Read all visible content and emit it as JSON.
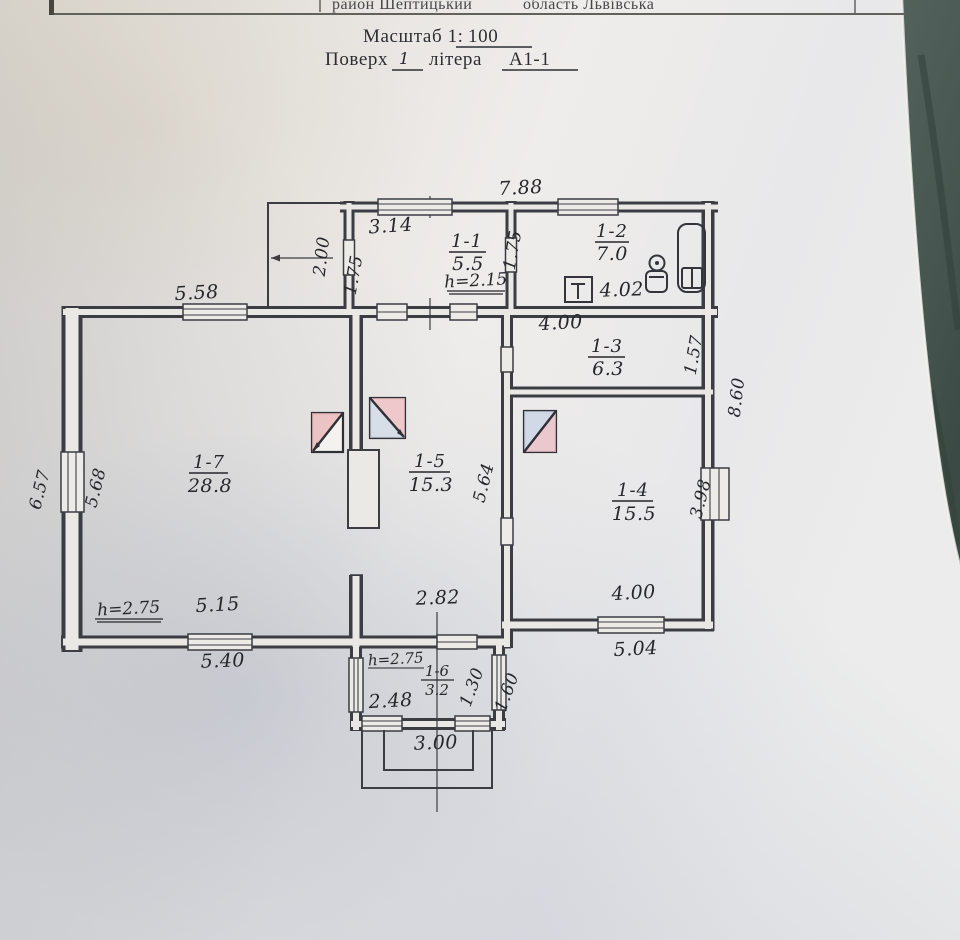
{
  "photo": {
    "paper_color": "#eae8e5",
    "background_color": "#4b5a54"
  },
  "header_table": {
    "district": "район Шептицький",
    "region": "область Львівська"
  },
  "title_block": {
    "scale_label": "Масштаб 1:",
    "scale_value": "100",
    "floor_label": "Поверх",
    "floor_value": "1",
    "letter_label": "літера",
    "letter_value": "А1-1"
  },
  "floor_plan": {
    "rooms": [
      {
        "id": "1-1",
        "area": "5.5"
      },
      {
        "id": "1-2",
        "area": "7.0"
      },
      {
        "id": "1-3",
        "area": "6.3"
      },
      {
        "id": "1-4",
        "area": "15.5"
      },
      {
        "id": "1-5",
        "area": "15.3"
      },
      {
        "id": "1-6",
        "area": "3.2"
      },
      {
        "id": "1-7",
        "area": "28.8"
      }
    ],
    "heights": {
      "room_1_1": "h=2.15",
      "room_1_7": "h=2.75",
      "room_1_6": "h=2.75"
    },
    "dimensions": {
      "top_overall": "7.88",
      "room_1_1_width": "3.14",
      "porch_depth": "2.00",
      "porch_opening": "1.75",
      "room_1_2_partition": "1.75",
      "room_1_2_width": "4.02",
      "room_1_7_top": "5.58",
      "left_wall_inner": "5.68",
      "left_wall_outer": "6.57",
      "room_1_3_width": "4.00",
      "room_1_3_depth": "1.57",
      "right_wall_outer": "8.60",
      "room_1_4_depth": "3.98",
      "room_1_5_depth": "5.64",
      "room_1_7_bottom": "5.15",
      "bottom_left_outer": "5.40",
      "room_1_5_bottom": "2.82",
      "room_1_4_bottom": "4.00",
      "bottom_right_outer": "5.04",
      "room_1_6_width": "2.48",
      "room_1_6_depth_inner": "1.30",
      "room_1_6_depth_outer": "1.60",
      "entrance_steps_width": "3.00"
    }
  }
}
